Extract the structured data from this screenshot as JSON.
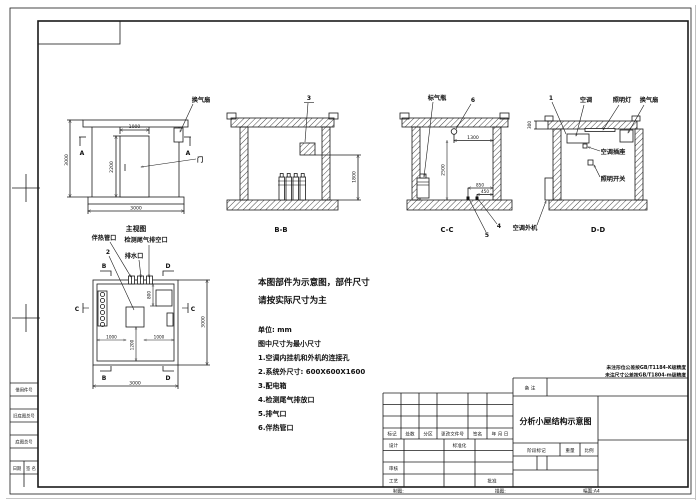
{
  "front": {
    "title": "主视图",
    "fan": "换气扇",
    "door": "门",
    "a1": "A",
    "a2": "A",
    "d1000": "1000",
    "d2200": "2200",
    "d3000l": "3000",
    "d3000b": "3000"
  },
  "bb": {
    "title": "B-B",
    "i3": "3",
    "d1800": "1800"
  },
  "cc": {
    "title": "C-C",
    "bottle": "标气瓶",
    "i6": "6",
    "d1300": "1300",
    "d2500": "2500",
    "d850": "850",
    "d450": "450",
    "i4": "4",
    "i5": "5",
    "outdoor": "空调外机"
  },
  "dd": {
    "title": "D-D",
    "i1": "1",
    "ac": "空调",
    "lamp": "照明灯",
    "fan": "换气扇",
    "d300": "300",
    "socket": "空调插座",
    "sw": "照明开关"
  },
  "plan": {
    "heat": "伴热管口",
    "vent": "检测尾气排空口",
    "drain": "排水口",
    "i2": "2",
    "b": "B",
    "c": "C",
    "d": "D",
    "d800": "800",
    "d1000a": "1000",
    "d1200": "1200",
    "d1000b": "1000",
    "d3000r": "3000",
    "d3000b": "3000"
  },
  "notes": {
    "l1": "本图部件为示意图，部件尺寸",
    "l2": "请按实际尺寸为主",
    "unit": "单位: mm",
    "min": "图中尺寸为最小尺寸",
    "n1": "1.空调内挂机和外机的连接孔",
    "n2": "2.系统外尺寸: 600X600X1600",
    "n3": "3.配电箱",
    "n4": "4.检测尾气排放口",
    "n5": "5.排气口",
    "n6": "6.伴热管口"
  },
  "tb": {
    "tol1": "未注形位公差按GB/T1184-K级精度",
    "tol2": "未注尺寸公差按GB/T1804-m级精度",
    "remark": "备 注",
    "title": "分析小屋结构示意图",
    "h1": "标记",
    "h2": "处数",
    "h3": "分区",
    "h4": "更改文件号",
    "h5": "签名",
    "h6": "年 月 日",
    "design": "设计",
    "std": "标准化",
    "review": "审核",
    "proc": "工艺",
    "appr": "批准",
    "stage": "阶段标记",
    "weight": "重量",
    "scale": "比例",
    "zhitu": "制图:",
    "miaotu": "描图:",
    "sheet": "幅面:A4"
  },
  "margin": {
    "r1": "借用件号",
    "r2": "旧底图总号",
    "r3": "底图总号",
    "date": "日期",
    "sign": "签 名"
  }
}
